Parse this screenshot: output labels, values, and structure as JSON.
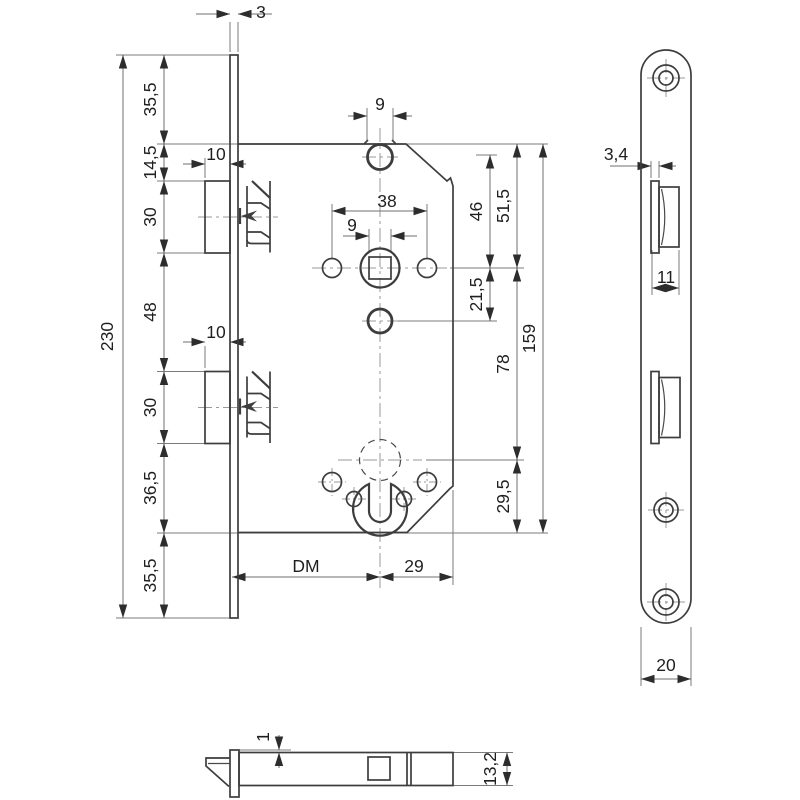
{
  "main_view": {
    "chain": [
      "35,5",
      "14,5",
      "30",
      "48",
      "30",
      "36,5",
      "35,5"
    ],
    "overall_height": "230",
    "faceplate_thickness": "3",
    "latch_projection": "10",
    "deadlatch_projection": "10",
    "top_hole_width": "9",
    "follower_square": "9",
    "fixing_hole_span": "38",
    "top_hole_to_follower": "46",
    "case_top_to_follower": "51,5",
    "follower_to_lower_hole": "21,5",
    "follower_to_cylinder": "78",
    "case_length": "159",
    "cylinder_to_case_bottom": "29,5",
    "backset": "DM",
    "center_to_case_back": "29"
  },
  "faceplate_view": {
    "latch_lip": "3,4",
    "latch_cutout_width": "11",
    "plate_width": "20"
  },
  "top_view": {
    "plate_to_case_offset": "1",
    "case_thickness": "13,2"
  }
}
